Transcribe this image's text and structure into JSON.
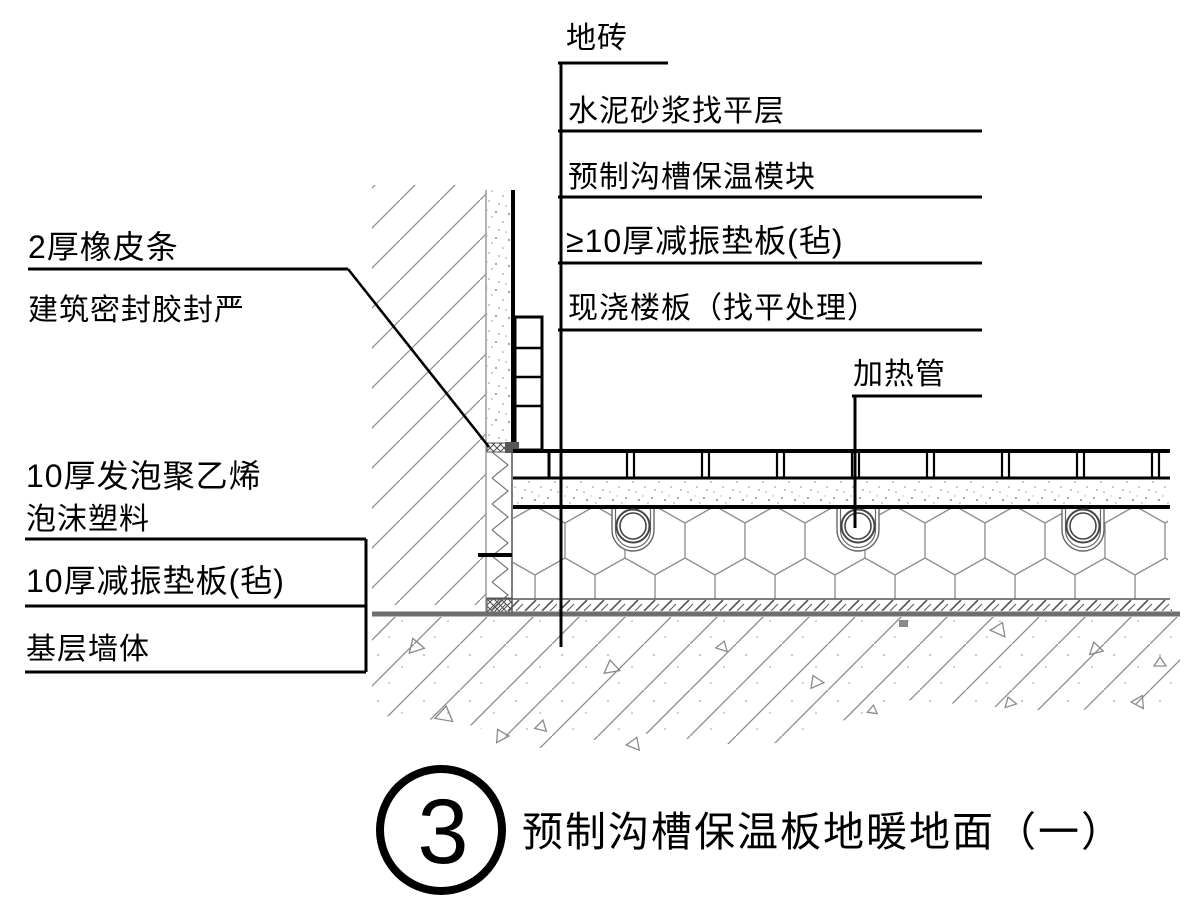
{
  "drawing": {
    "kind": "construction-detail-section",
    "right_labels": {
      "floor_tile": "地砖",
      "mortar_leveling": "水泥砂浆找平层",
      "insulation_module": "预制沟槽保温模块",
      "damping_pad": "≥10厚减振垫板(毡)",
      "cast_slab": "现浇楼板（找平处理）",
      "heating_pipe": "加热管"
    },
    "left_labels": {
      "rubber_strip": "2厚橡皮条",
      "sealant": "建筑密封胶封严",
      "foam_line1": "10厚发泡聚乙烯",
      "foam_line2": "泡沫塑料",
      "damping_pad": "10厚减振垫板(毡)",
      "base_wall": "基层墙体"
    },
    "title": {
      "number": "3",
      "text": "预制沟槽保温板地暖地面（一）"
    },
    "colors": {
      "line": "#000000",
      "hatch": "#8a8a8a",
      "thick_gray": "#6f6f6f"
    }
  }
}
